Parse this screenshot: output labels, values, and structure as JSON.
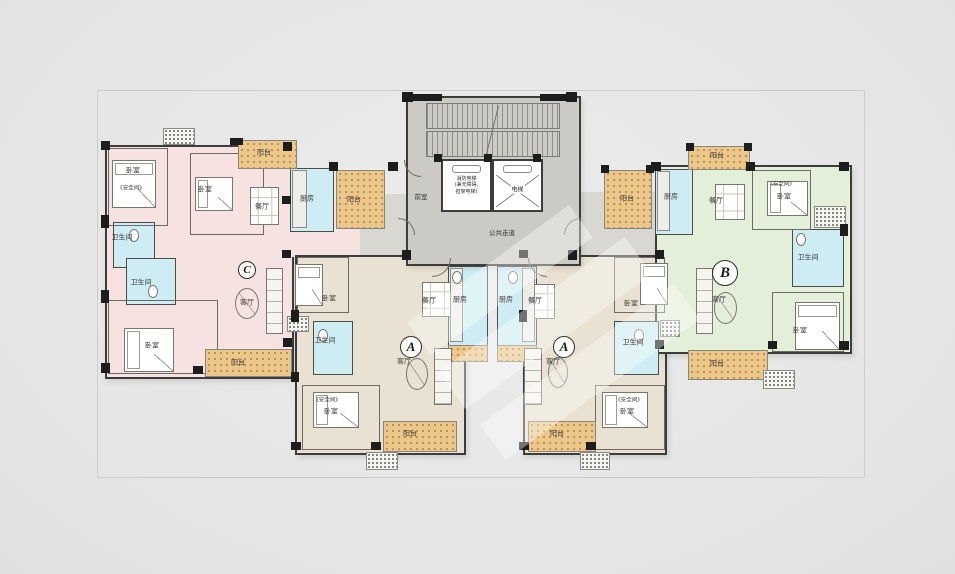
{
  "colors": {
    "bg": "#e7e7e7",
    "wall": "#3c3c3c",
    "unit_pink": "#f7e2e2",
    "unit_green": "#e4efd9",
    "unit_tan": "#e9e1d1",
    "wet_cyan": "#cdecf3",
    "core_gray": "#cbcac4",
    "balcony_orange": "#ebc78c",
    "label": "#3a3a3a"
  },
  "core": {
    "elevator1_lines": [
      "消防电梯",
      "(兼无障碍,",
      "担架电梯)"
    ],
    "elevator2_label": "电梯",
    "lobby_label": "前室",
    "corridor_label": "公共走道"
  },
  "plan": {
    "areas": [
      {
        "n": "unit-c-floor",
        "f": "pink",
        "x": 105,
        "y": 145,
        "w": 185,
        "h": 230,
        "walled": true
      },
      {
        "n": "unit-c-hall",
        "f": "pink",
        "x": 285,
        "y": 200,
        "w": 112,
        "h": 57,
        "walled": false
      },
      {
        "n": "corridor-left",
        "f": "corridor",
        "x": 360,
        "y": 194,
        "w": 48,
        "h": 63,
        "walled": false
      },
      {
        "n": "corridor-right",
        "f": "corridor",
        "x": 575,
        "y": 192,
        "w": 80,
        "h": 66,
        "walled": false
      },
      {
        "n": "unit-a-left-floor",
        "f": "tan",
        "x": 295,
        "y": 255,
        "w": 167,
        "h": 196,
        "walled": true
      },
      {
        "n": "unit-a-right-floor",
        "f": "tan",
        "x": 523,
        "y": 255,
        "w": 140,
        "h": 196,
        "walled": true
      },
      {
        "n": "unit-b-floor",
        "f": "green",
        "x": 655,
        "y": 165,
        "w": 193,
        "h": 185,
        "walled": true
      },
      {
        "n": "kitchen-c",
        "f": "cyan",
        "x": 290,
        "y": 168,
        "w": 42,
        "h": 62,
        "thin": true
      },
      {
        "n": "bath-c-upper",
        "f": "cyan",
        "x": 113,
        "y": 222,
        "w": 40,
        "h": 44,
        "thin": true
      },
      {
        "n": "bath-c-lower",
        "f": "cyan",
        "x": 126,
        "y": 258,
        "w": 48,
        "h": 45,
        "thin": true
      },
      {
        "n": "kitchen-a-left",
        "f": "cyan",
        "x": 448,
        "y": 266,
        "w": 38,
        "h": 79,
        "thin": true
      },
      {
        "n": "kitchen-a-right",
        "f": "cyan",
        "x": 497,
        "y": 266,
        "w": 38,
        "h": 79,
        "thin": true
      },
      {
        "n": "bath-a-left",
        "f": "cyan",
        "x": 313,
        "y": 321,
        "w": 38,
        "h": 52,
        "thin": true
      },
      {
        "n": "bath-a-right",
        "f": "cyan",
        "x": 614,
        "y": 321,
        "w": 43,
        "h": 52,
        "thin": true
      },
      {
        "n": "kitchen-b",
        "f": "cyan",
        "x": 655,
        "y": 169,
        "w": 36,
        "h": 64,
        "thin": true
      },
      {
        "n": "bath-b",
        "f": "cyan",
        "x": 792,
        "y": 229,
        "w": 50,
        "h": 56,
        "thin": true
      }
    ],
    "rooms": [
      {
        "n": "bedroom-c1",
        "x": 108,
        "y": 148,
        "w": 58,
        "h": 76
      },
      {
        "n": "bedroom-c2",
        "x": 190,
        "y": 153,
        "w": 72,
        "h": 80
      },
      {
        "n": "bedroom-c3",
        "x": 108,
        "y": 300,
        "w": 108,
        "h": 72
      },
      {
        "n": "bedroom-a-left-top",
        "x": 297,
        "y": 257,
        "w": 50,
        "h": 54
      },
      {
        "n": "bedroom-a-left-bottom",
        "x": 302,
        "y": 385,
        "w": 76,
        "h": 63
      },
      {
        "n": "bedroom-a-right-top",
        "x": 614,
        "y": 257,
        "w": 49,
        "h": 54
      },
      {
        "n": "bedroom-a-right-bottom",
        "x": 595,
        "y": 385,
        "w": 68,
        "h": 63
      },
      {
        "n": "bedroom-b-top",
        "x": 752,
        "y": 170,
        "w": 57,
        "h": 58
      },
      {
        "n": "bedroom-b-right",
        "x": 772,
        "y": 292,
        "w": 70,
        "h": 58
      }
    ],
    "balconies": [
      {
        "n": "balcony-c-top",
        "x": 238,
        "y": 140,
        "w": 57,
        "h": 27
      },
      {
        "n": "balcony-c-mid",
        "x": 336,
        "y": 170,
        "w": 47,
        "h": 57
      },
      {
        "n": "balcony-c-bottom",
        "x": 205,
        "y": 349,
        "w": 85,
        "h": 26
      },
      {
        "n": "balcony-a-left",
        "x": 383,
        "y": 421,
        "w": 72,
        "h": 29
      },
      {
        "n": "balcony-a-right",
        "x": 528,
        "y": 421,
        "w": 66,
        "h": 29
      },
      {
        "n": "service-balcony-left",
        "x": 448,
        "y": 345,
        "w": 38,
        "h": 15
      },
      {
        "n": "service-balcony-right",
        "x": 497,
        "y": 345,
        "w": 38,
        "h": 15
      },
      {
        "n": "balcony-b-top",
        "x": 688,
        "y": 146,
        "w": 60,
        "h": 22
      },
      {
        "n": "balcony-b-mid",
        "x": 604,
        "y": 170,
        "w": 46,
        "h": 57
      },
      {
        "n": "balcony-b-bottom",
        "x": 688,
        "y": 350,
        "w": 78,
        "h": 28
      }
    ],
    "ac_units": [
      {
        "x": 163,
        "y": 128,
        "w": 30,
        "h": 15
      },
      {
        "x": 814,
        "y": 206,
        "w": 30,
        "h": 20
      },
      {
        "x": 763,
        "y": 370,
        "w": 30,
        "h": 17
      },
      {
        "x": 366,
        "y": 452,
        "w": 30,
        "h": 16
      },
      {
        "x": 580,
        "y": 452,
        "w": 28,
        "h": 16
      },
      {
        "x": 287,
        "y": 316,
        "w": 20,
        "h": 14
      },
      {
        "x": 660,
        "y": 320,
        "w": 18,
        "h": 15
      }
    ],
    "columns": [
      [
        101,
        141,
        9,
        9
      ],
      [
        230,
        138,
        13,
        7
      ],
      [
        283,
        142,
        9,
        9
      ],
      [
        101,
        215,
        8,
        13
      ],
      [
        101,
        290,
        8,
        13
      ],
      [
        101,
        363,
        9,
        10
      ],
      [
        193,
        366,
        10,
        8
      ],
      [
        283,
        338,
        9,
        9
      ],
      [
        282,
        196,
        9,
        8
      ],
      [
        329,
        162,
        9,
        9
      ],
      [
        388,
        162,
        10,
        9
      ],
      [
        282,
        250,
        9,
        8
      ],
      [
        291,
        310,
        8,
        12
      ],
      [
        291,
        372,
        8,
        10
      ],
      [
        291,
        442,
        10,
        8
      ],
      [
        371,
        442,
        10,
        8
      ],
      [
        402,
        92,
        11,
        10
      ],
      [
        566,
        92,
        11,
        10
      ],
      [
        402,
        250,
        9,
        10
      ],
      [
        568,
        250,
        9,
        10
      ],
      [
        406,
        94,
        36,
        7
      ],
      [
        540,
        94,
        36,
        7
      ],
      [
        434,
        154,
        8,
        8
      ],
      [
        484,
        154,
        8,
        8
      ],
      [
        533,
        154,
        8,
        8
      ],
      [
        519,
        250,
        9,
        8
      ],
      [
        519,
        310,
        8,
        12
      ],
      [
        519,
        442,
        10,
        8
      ],
      [
        586,
        442,
        10,
        8
      ],
      [
        655,
        250,
        9,
        9
      ],
      [
        655,
        340,
        9,
        9
      ],
      [
        651,
        162,
        10,
        9
      ],
      [
        746,
        162,
        9,
        9
      ],
      [
        839,
        162,
        10,
        9
      ],
      [
        840,
        224,
        8,
        12
      ],
      [
        839,
        341,
        10,
        9
      ],
      [
        768,
        341,
        9,
        8
      ],
      [
        601,
        165,
        8,
        8
      ],
      [
        646,
        165,
        8,
        8
      ],
      [
        686,
        143,
        8,
        8
      ],
      [
        744,
        143,
        8,
        8
      ]
    ],
    "labels": [
      {
        "n": "label-bedroom-c1",
        "t": "卧室",
        "x": 133,
        "y": 171
      },
      {
        "n": "label-safe-room-c1",
        "t": "《安全间》",
        "x": 131,
        "y": 189,
        "s": 5.5
      },
      {
        "n": "label-bedroom-c2",
        "t": "卧室",
        "x": 205,
        "y": 190
      },
      {
        "n": "label-dining-c",
        "t": "餐厅",
        "x": 262,
        "y": 207
      },
      {
        "n": "label-balcony-c-top",
        "t": "阳台",
        "x": 264,
        "y": 153
      },
      {
        "n": "label-kitchen-c",
        "t": "厨房",
        "x": 307,
        "y": 199
      },
      {
        "n": "label-balcony-c-mid",
        "t": "阳台",
        "x": 354,
        "y": 200
      },
      {
        "n": "label-bath-c-upper",
        "t": "卫生间",
        "x": 122,
        "y": 238
      },
      {
        "n": "label-bath-c-lower",
        "t": "卫生间",
        "x": 141,
        "y": 283
      },
      {
        "n": "label-bedroom-c3",
        "t": "卧室",
        "x": 152,
        "y": 346
      },
      {
        "n": "label-living-c",
        "t": "客厅",
        "x": 247,
        "y": 303
      },
      {
        "n": "label-balcony-c-bottom",
        "t": "阳台",
        "x": 238,
        "y": 363
      },
      {
        "n": "label-bedroom-al1",
        "t": "卧室",
        "x": 329,
        "y": 299
      },
      {
        "n": "label-dining-al",
        "t": "餐厅",
        "x": 429,
        "y": 301
      },
      {
        "n": "label-kitchen-al",
        "t": "厨房",
        "x": 460,
        "y": 300
      },
      {
        "n": "label-bath-al",
        "t": "卫生间",
        "x": 325,
        "y": 341
      },
      {
        "n": "label-living-al",
        "t": "客厅",
        "x": 404,
        "y": 362
      },
      {
        "n": "label-safe-room-al",
        "t": "《安全间》",
        "x": 327,
        "y": 401,
        "s": 5.5
      },
      {
        "n": "label-bedroom-al2",
        "t": "卧室",
        "x": 331,
        "y": 412
      },
      {
        "n": "label-balcony-al",
        "t": "阳台",
        "x": 410,
        "y": 434
      },
      {
        "n": "label-kitchen-ar",
        "t": "厨房",
        "x": 506,
        "y": 300
      },
      {
        "n": "label-dining-ar",
        "t": "餐厅",
        "x": 535,
        "y": 301
      },
      {
        "n": "label-bedroom-ar1",
        "t": "卧室",
        "x": 631,
        "y": 304
      },
      {
        "n": "label-bath-ar",
        "t": "卫生间",
        "x": 633,
        "y": 343
      },
      {
        "n": "label-living-ar",
        "t": "客厅",
        "x": 553,
        "y": 362
      },
      {
        "n": "label-safe-room-ar",
        "t": "《安全间》",
        "x": 629,
        "y": 401,
        "s": 5.5
      },
      {
        "n": "label-bedroom-ar2",
        "t": "卧室",
        "x": 627,
        "y": 412
      },
      {
        "n": "label-balcony-ar",
        "t": "阳台",
        "x": 557,
        "y": 434
      },
      {
        "n": "label-balcony-b-top",
        "t": "阳台",
        "x": 717,
        "y": 156
      },
      {
        "n": "label-kitchen-b",
        "t": "厨房",
        "x": 671,
        "y": 197
      },
      {
        "n": "label-balcony-b-mid",
        "t": "阳台",
        "x": 627,
        "y": 199
      },
      {
        "n": "label-dining-b",
        "t": "餐厅",
        "x": 716,
        "y": 201
      },
      {
        "n": "label-safe-room-b",
        "t": "《安全间》",
        "x": 781,
        "y": 185,
        "s": 5.5
      },
      {
        "n": "label-bedroom-b1",
        "t": "卧室",
        "x": 784,
        "y": 197
      },
      {
        "n": "label-bath-b",
        "t": "卫生间",
        "x": 808,
        "y": 258
      },
      {
        "n": "label-bedroom-b2",
        "t": "卧室",
        "x": 800,
        "y": 331
      },
      {
        "n": "label-living-b",
        "t": "客厅",
        "x": 719,
        "y": 300
      },
      {
        "n": "label-balcony-b-bottom",
        "t": "阳台",
        "x": 717,
        "y": 364
      }
    ],
    "markers": [
      {
        "n": "unit-marker-c",
        "t": "C",
        "x": 246,
        "y": 269,
        "r": 8
      },
      {
        "n": "unit-marker-a-left",
        "t": "A",
        "x": 410,
        "y": 346,
        "r": 10
      },
      {
        "n": "unit-marker-a-right",
        "t": "A",
        "x": 563,
        "y": 346,
        "r": 10
      },
      {
        "n": "unit-marker-b",
        "t": "B",
        "x": 724,
        "y": 272,
        "r": 12
      }
    ],
    "furniture": {
      "beds": [
        [
          112,
          160,
          42,
          46
        ],
        [
          195,
          177,
          36,
          32
        ],
        [
          124,
          328,
          48,
          42
        ],
        [
          295,
          264,
          26,
          40
        ],
        [
          313,
          392,
          44,
          34
        ],
        [
          640,
          263,
          26,
          40
        ],
        [
          602,
          392,
          44,
          34
        ],
        [
          767,
          181,
          39,
          33
        ],
        [
          795,
          302,
          43,
          46
        ]
      ],
      "tables": [
        [
          250,
          187,
          27,
          36
        ],
        [
          422,
          282,
          28,
          33
        ],
        [
          526,
          284,
          27,
          33
        ],
        [
          715,
          184,
          28,
          34
        ]
      ],
      "sofas": [
        [
          266,
          268,
          15,
          64
        ],
        [
          696,
          268,
          15,
          64
        ],
        [
          434,
          348,
          16,
          55
        ],
        [
          524,
          348,
          16,
          55
        ]
      ],
      "ovals": [
        [
          235,
          288,
          22,
          29
        ],
        [
          406,
          358,
          20,
          30
        ],
        [
          548,
          357,
          18,
          29
        ],
        [
          714,
          292,
          21,
          30
        ]
      ],
      "counters": [
        [
          292,
          170,
          13,
          56
        ],
        [
          450,
          268,
          11,
          72
        ],
        [
          522,
          268,
          11,
          72
        ],
        [
          657,
          171,
          11,
          58
        ]
      ],
      "wc": [
        [
          133,
          234
        ],
        [
          152,
          290
        ],
        [
          322,
          334
        ],
        [
          638,
          334
        ],
        [
          800,
          238
        ],
        [
          456,
          276
        ],
        [
          512,
          276
        ]
      ]
    },
    "doors": [
      {
        "x": 432,
        "y": 258,
        "r": 18,
        "q": "se"
      },
      {
        "x": 546,
        "y": 258,
        "r": 18,
        "q": "sw"
      },
      {
        "x": 398,
        "y": 234,
        "r": 16,
        "q": "ne"
      },
      {
        "x": 580,
        "y": 234,
        "r": 16,
        "q": "nw"
      },
      {
        "x": 420,
        "y": 160,
        "r": 16,
        "q": "sw"
      }
    ],
    "watermark": [
      [
        400,
        260,
        200,
        40
      ],
      [
        430,
        300,
        230,
        46
      ],
      [
        470,
        350,
        240,
        44
      ]
    ]
  }
}
